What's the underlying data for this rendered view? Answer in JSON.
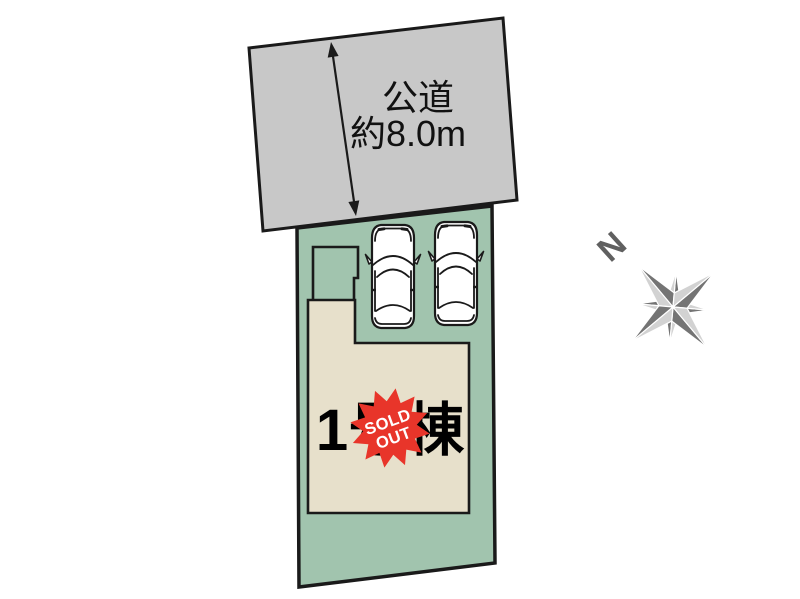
{
  "diagram_type": "real-estate-plot-layout",
  "road": {
    "name_label": "公道",
    "width_label": "約8.0m"
  },
  "plot": {
    "building": {
      "label": "1号棟"
    },
    "parking": {
      "car_icon_count": 2
    }
  },
  "sold_out_badge": {
    "line1": "SOLD",
    "line2": "OUT"
  },
  "compass": {
    "north_label": "N"
  },
  "icons": {
    "car": "car-top-view-icon",
    "compass": "compass-rose-8-point-icon",
    "road_width": "double-headed-arrow-icon",
    "sold_out": "starburst-badge-icon"
  },
  "colors": {
    "road_fill": "#c8c8c8",
    "plot_fill": "#a1c4ae",
    "building_fill": "#e7e0cb",
    "badge_fill": "#e8352a",
    "badge_text": "#ffffff",
    "outline": "#1a1a1a",
    "compass_dark": "#747474",
    "compass_light": "#d2d2d2",
    "car_fill": "#ffffff",
    "label_text": "#111111"
  }
}
